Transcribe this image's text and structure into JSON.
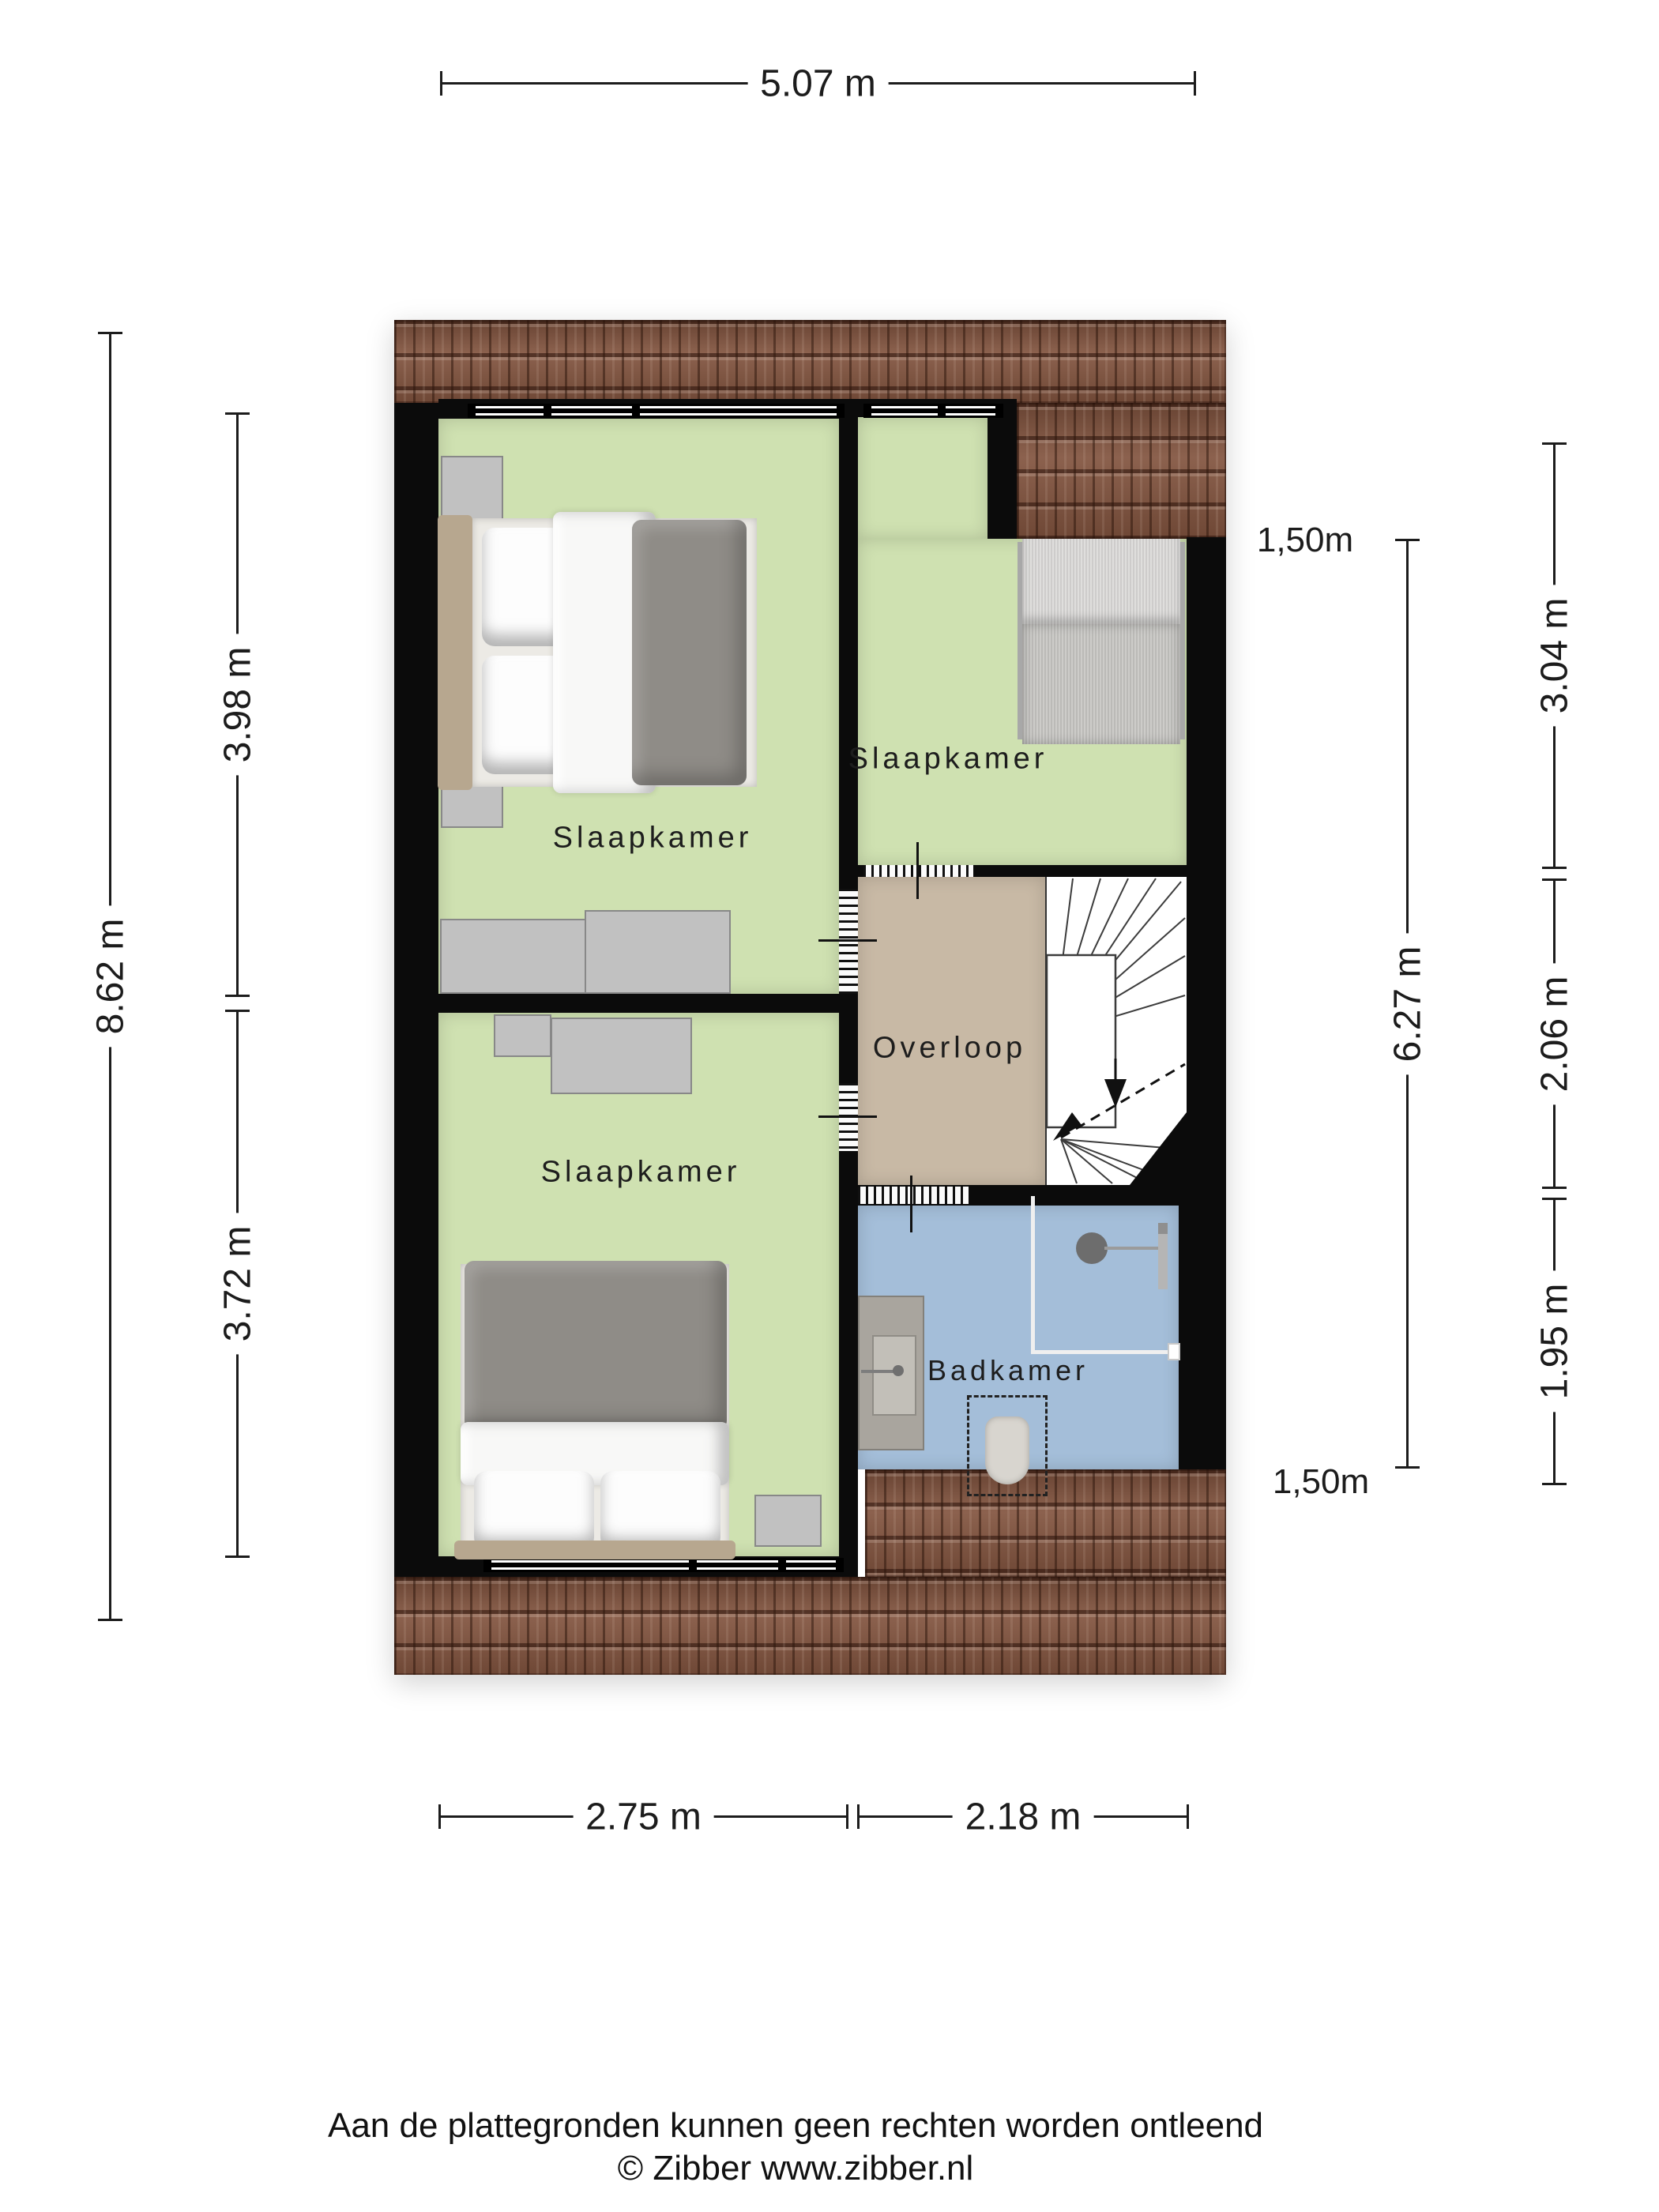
{
  "colors": {
    "room_green": "#cfe1b1",
    "hall_tan": "#c8b9a5",
    "bath_blue": "#a4bed9",
    "wall": "#0b0b0b",
    "roof_base": "#82543f",
    "furn_gray": "#c1c1c1",
    "bed_duvet": "#8f8c87",
    "headboard_tan": "#b7a78f",
    "dim_color": "#1c1c1c"
  },
  "rooms": {
    "bedroom_top_left": {
      "label": "Slaapkamer"
    },
    "bedroom_top_right": {
      "label": "Slaapkamer"
    },
    "bedroom_bottom_left": {
      "label": "Slaapkamer"
    },
    "landing": {
      "label": "Overloop"
    },
    "bathroom": {
      "label": "Badkamer"
    }
  },
  "dimensions": {
    "top_width": {
      "label": "5.07 m"
    },
    "top_right_width": {
      "label": "2.22 m"
    },
    "left_height": {
      "label": "8.62 m"
    },
    "left_upper": {
      "label": "3.98 m"
    },
    "left_lower": {
      "label": "3.72 m"
    },
    "right_height": {
      "label": "6.27 m"
    },
    "right_upper": {
      "label": "3.04 m"
    },
    "right_middle": {
      "label": "2.06 m"
    },
    "right_lower": {
      "label": "1.95 m"
    },
    "clearance_top": {
      "label": "1,50m"
    },
    "clearance_bottom": {
      "label": "1,50m"
    },
    "bottom_left_width": {
      "label": "2.75 m"
    },
    "bottom_right_width": {
      "label": "2.18 m"
    }
  },
  "footer": {
    "disclaimer": "Aan de plattegronden kunnen geen rechten worden ontleend",
    "credit": "© Zibber www.zibber.nl"
  }
}
